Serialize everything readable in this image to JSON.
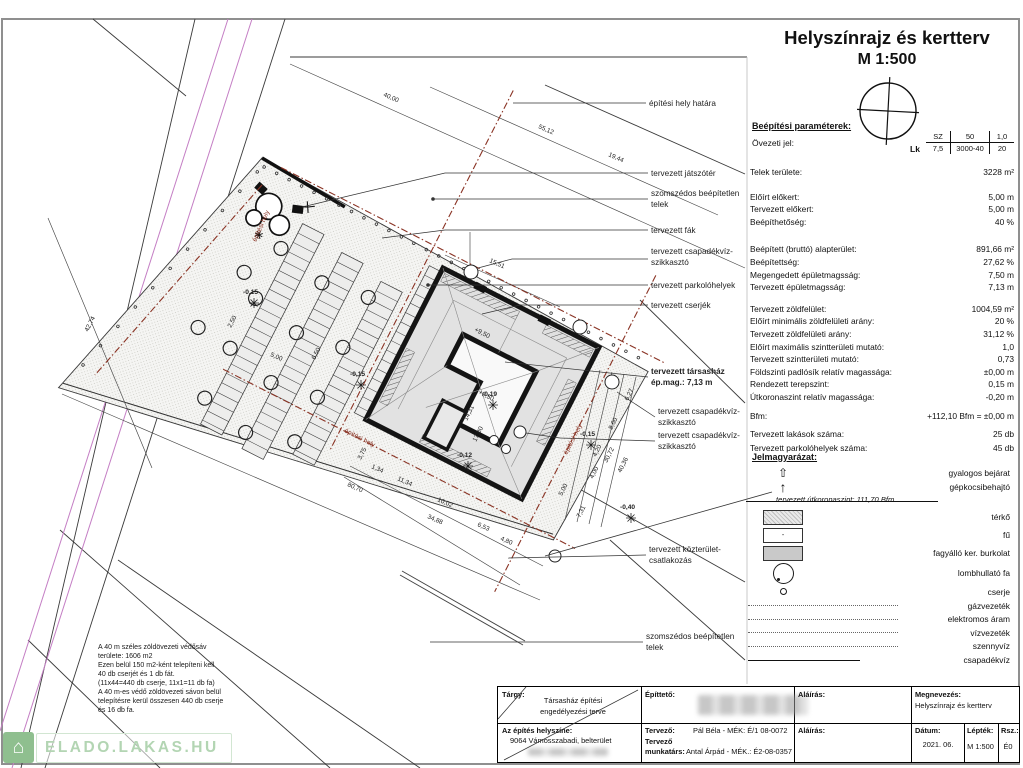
{
  "title": {
    "line1": "Helyszínrajz és kertterv",
    "line2": "M 1:500"
  },
  "params": {
    "heading": "Beépítési paraméterek:",
    "zone_label": "Övezeti jel:",
    "zone_code": "Lk",
    "zone_table": {
      "r1": [
        "SZ",
        "50",
        "1,0"
      ],
      "r2": [
        "7,5",
        "3000-40",
        "20"
      ]
    },
    "rows": [
      {
        "l": "Telek területe:",
        "v": "3228 m²",
        "g": 0
      },
      {
        "l": "Előírt előkert:",
        "v": "5,00 m",
        "g": 12
      },
      {
        "l": "Tervezett előkert:",
        "v": "5,00 m",
        "g": 0
      },
      {
        "l": "Beépíthetőség:",
        "v": "40 %",
        "g": 0
      },
      {
        "l": "Beépített (bruttó) alapterület:",
        "v": "891,66 m²",
        "g": 15
      },
      {
        "l": "Beépítettség:",
        "v": "27,62 %",
        "g": 0
      },
      {
        "l": "Megengedett épületmagsság:",
        "v": "7,50 m",
        "g": 0
      },
      {
        "l": "Tervezett épületmagsság:",
        "v": "7,13 m",
        "g": 0
      },
      {
        "l": "Tervezett zöldfelület:",
        "v": "1004,59 m²",
        "g": 9
      },
      {
        "l": "Előírt minimális zöldfelületi arány:",
        "v": "20 %",
        "g": 0
      },
      {
        "l": "Tervezett zöldfelületi arány:",
        "v": "31,12 %",
        "g": 0
      },
      {
        "l": "Előírt maximális szintterületi mutató:",
        "v": "1,0",
        "g": 0
      },
      {
        "l": "Tervezett szintterületi mutató:",
        "v": "0,73",
        "g": 0
      },
      {
        "l": "Földszinti padlósík relatív magassága:",
        "v": "±0,00 m",
        "g": 0
      },
      {
        "l": "Rendezett terepszint:",
        "v": "0,15 m",
        "g": 0
      },
      {
        "l": "Útkoronaszint relatív magassága:",
        "v": "-0,20 m",
        "g": 0
      },
      {
        "l": "Bfm:",
        "v": "+112,10 Bfm = ±0,00 m",
        "g": 6
      },
      {
        "l": "Tervezett lakások száma:",
        "v": "25 db",
        "g": 6
      },
      {
        "l": "Tervezett parkolóhelyek száma:",
        "v": "45 db",
        "g": 1
      }
    ]
  },
  "legend": {
    "heading": "Jelmagyarázat:",
    "road_label": "tervezett útkoronaszint: 111,70 Bfm",
    "items": [
      {
        "t": "arrow-outline",
        "label": "gyalogos bejárat"
      },
      {
        "t": "arrow-filled",
        "label": "gépkocsibehajtó"
      },
      {
        "t": "roadline",
        "label": ""
      },
      {
        "t": "swatch-dotted",
        "label": "térkő"
      },
      {
        "t": "swatch-plain",
        "label": "fű"
      },
      {
        "t": "swatch-gray",
        "label": "fagyálló ker. burkolat"
      },
      {
        "t": "tree",
        "label": "lombhullató fa"
      },
      {
        "t": "shrub",
        "label": "cserje"
      },
      {
        "t": "utility",
        "label": "gázvezeték"
      },
      {
        "t": "utility",
        "label": "elektromos áram"
      },
      {
        "t": "utility",
        "label": "vízvezeték"
      },
      {
        "t": "utility",
        "label": "szennyvíz"
      },
      {
        "t": "solidline",
        "label": "csapadékvíz"
      }
    ]
  },
  "building": {
    "marks": [
      "+9,50",
      "+9,50"
    ]
  },
  "drawing": {
    "callouts": [
      {
        "lines": [
          "építési hely határa"
        ],
        "x": 649,
        "y": 106,
        "leader": [
          [
            646,
            103
          ],
          [
            513,
            103
          ]
        ]
      },
      {
        "lines": [
          "tervezett játszótér"
        ],
        "x": 651,
        "y": 176,
        "leader": [
          [
            648,
            173
          ],
          [
            445,
            173
          ],
          [
            302,
            207
          ]
        ]
      },
      {
        "lines": [
          "szomszédos beépítetlen",
          "telek"
        ],
        "x": 651,
        "y": 196,
        "dot": true,
        "leader": [
          [
            648,
            199
          ],
          [
            433,
            199
          ]
        ]
      },
      {
        "lines": [
          "tervezett fák"
        ],
        "x": 651,
        "y": 233,
        "leader": [
          [
            648,
            230
          ],
          [
            445,
            230
          ],
          [
            382,
            238
          ]
        ]
      },
      {
        "lines": [
          "tervezett csapadékvíz-",
          "szikkasztó"
        ],
        "x": 651,
        "y": 254,
        "leader": [
          [
            648,
            259
          ],
          [
            512,
            259
          ],
          [
            478,
            268
          ]
        ]
      },
      {
        "lines": [
          "tervezett parkolóhelyek"
        ],
        "x": 651,
        "y": 288,
        "dot": true,
        "leader": [
          [
            648,
            285
          ],
          [
            428,
            285
          ]
        ]
      },
      {
        "lines": [
          "tervezett cserjék"
        ],
        "x": 651,
        "y": 308,
        "leader": [
          [
            648,
            305
          ],
          [
            520,
            305
          ],
          [
            482,
            314
          ]
        ]
      },
      {
        "lines": [
          "tervezett társasház",
          "ép.mag.:  7,13 m"
        ],
        "x": 651,
        "y": 374,
        "bold": true,
        "leader": [
          [
            648,
            377
          ],
          [
            505,
            362
          ]
        ]
      },
      {
        "lines": [
          "tervezett csapadékvíz-",
          "szikkasztó"
        ],
        "x": 658,
        "y": 414,
        "leader": [
          [
            655,
            417
          ],
          [
            617,
            392
          ]
        ]
      },
      {
        "lines": [
          "tervezett csapadékvíz-",
          "szikkasztó"
        ],
        "x": 658,
        "y": 438,
        "leader": [
          [
            655,
            441
          ],
          [
            560,
            438
          ],
          [
            526,
            433
          ]
        ]
      },
      {
        "lines": [
          "tervezett közterület-",
          "csatlakozás"
        ],
        "x": 649,
        "y": 552,
        "leader": [
          [
            646,
            555
          ],
          [
            508,
            558
          ]
        ]
      },
      {
        "lines": [
          "szomszédos beépítetlen",
          "telek"
        ],
        "x": 646,
        "y": 639,
        "leader": [
          [
            643,
            642
          ],
          [
            430,
            642
          ]
        ]
      }
    ],
    "dims": [
      {
        "t": "40,00",
        "x": 383,
        "y": 96,
        "r": 24
      },
      {
        "t": "55,12",
        "x": 538,
        "y": 128,
        "r": 24
      },
      {
        "t": "19,44",
        "x": 608,
        "y": 156,
        "r": 24
      },
      {
        "t": "15,51",
        "x": 489,
        "y": 262,
        "r": 24
      },
      {
        "t": "42,74",
        "x": 88,
        "y": 332,
        "r": -63
      },
      {
        "t": "80,70",
        "x": 347,
        "y": 486,
        "r": 24
      },
      {
        "t": "1,34",
        "x": 371,
        "y": 468,
        "r": 24
      },
      {
        "t": "11,34",
        "x": 397,
        "y": 480,
        "r": 24
      },
      {
        "t": "10,02",
        "x": 437,
        "y": 501,
        "r": 24
      },
      {
        "t": "34,88",
        "x": 427,
        "y": 518,
        "r": 24
      },
      {
        "t": "6,53",
        "x": 477,
        "y": 526,
        "r": 24
      },
      {
        "t": "4,80",
        "x": 500,
        "y": 540,
        "r": 24
      },
      {
        "t": "6,27",
        "x": 628,
        "y": 401,
        "r": -63
      },
      {
        "t": "8,60",
        "x": 612,
        "y": 430,
        "r": -63
      },
      {
        "t": "4,20",
        "x": 596,
        "y": 457,
        "r": -63
      },
      {
        "t": "30,72",
        "x": 607,
        "y": 463,
        "r": -63
      },
      {
        "t": "40,36",
        "x": 621,
        "y": 473,
        "r": -63
      },
      {
        "t": "4,00",
        "x": 593,
        "y": 479,
        "r": -63
      },
      {
        "t": "5,00",
        "x": 562,
        "y": 496,
        "r": -63
      },
      {
        "t": "7,31",
        "x": 580,
        "y": 518,
        "r": -63
      },
      {
        "t": "3,75",
        "x": 361,
        "y": 460,
        "r": -63
      },
      {
        "t": "14,31",
        "x": 467,
        "y": 421,
        "r": -63
      },
      {
        "t": "17,80",
        "x": 476,
        "y": 442,
        "r": -63
      },
      {
        "t": "5,00",
        "x": 270,
        "y": 356,
        "r": 24
      },
      {
        "t": "6,50",
        "x": 315,
        "y": 360,
        "r": -63
      },
      {
        "t": "2,50",
        "x": 231,
        "y": 328,
        "r": -63
      }
    ],
    "spots": [
      {
        "t": "-0,15",
        "x": 243,
        "y": 294
      },
      {
        "t": "-0,15",
        "x": 350,
        "y": 376
      },
      {
        "t": "-0,15",
        "x": 580,
        "y": 436
      },
      {
        "t": "-0,40",
        "x": 620,
        "y": 509
      },
      {
        "t": "-0,12",
        "x": 457,
        "y": 457
      },
      {
        "t": "-0,19",
        "x": 482,
        "y": 396
      }
    ],
    "red_labels": [
      {
        "t": "építési hely",
        "x": 256,
        "y": 242,
        "r": -66
      },
      {
        "t": "építési hely",
        "x": 344,
        "y": 432,
        "r": 27
      },
      {
        "t": "építési hely",
        "x": 567,
        "y": 455,
        "r": -63
      }
    ]
  },
  "notes": {
    "lines": [
      "A 40 m széles zöldövezeti védősáv",
      "területe: 1606 m2",
      "Ezen belül 150 m2-ként telepíteni kell",
      "40 db cserjét és 1 db fát.",
      "(11x44=440 db cserje, 11x1=11 db fa)",
      "A 40 m-es védő zöldövezeti sávon belül",
      "telepítésre kerül összesen 440 db cserje",
      "és 16 db fa."
    ]
  },
  "titleblock": {
    "targy_label": "Tárgy:",
    "targy1": "Társasház építési",
    "targy2": "engedélyezési terve",
    "epitteto_label": "Építtető:",
    "alairas_label": "Aláírás:",
    "megnevezes_label": "Megnevezés:",
    "megnevezes": "Helyszínrajz és kertterv",
    "helyszin_label": "Az építés helyszíne:",
    "helyszin": "9064 Vámosszabadi, belterület",
    "tervezo_label": "Tervező:",
    "tervezo": "Pál Béla - MÉK: É/1 08-0072",
    "tervezo2_label": "Tervező",
    "munkatars_label": "munkatárs:",
    "munkatars": "Antal Árpád - MÉK.: É2-08-0357",
    "datum_label": "Dátum:",
    "datum": "2021. 06.",
    "leptek_label": "Lépték:",
    "leptek": "M 1:500",
    "rsz_label": "Rsz.:",
    "rsz": "É0"
  },
  "watermark": {
    "text": "ELADO.LAKAS.HU"
  }
}
